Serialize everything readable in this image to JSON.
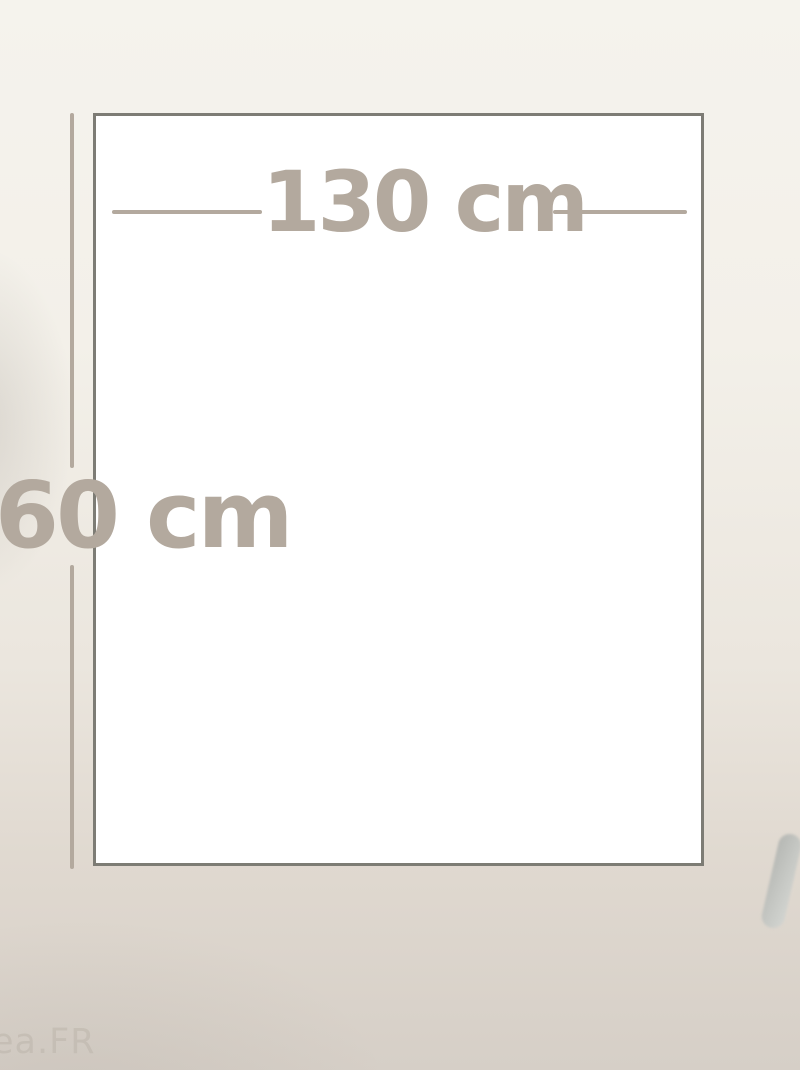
{
  "diagram": {
    "width_label": "130 cm",
    "height_label": "60 cm"
  },
  "watermark": {
    "text": "ea.FR"
  },
  "colors": {
    "dimension": "#b3a99e",
    "outline_border": "#7d7c75",
    "outline_fill": "#ffffff",
    "background_top": "#f5f3ed",
    "background_bottom": "#d6cfc7",
    "watermark": "#c2bbb1",
    "object_dark": "#b5b7b3",
    "object_light": "#d3d5d1"
  }
}
